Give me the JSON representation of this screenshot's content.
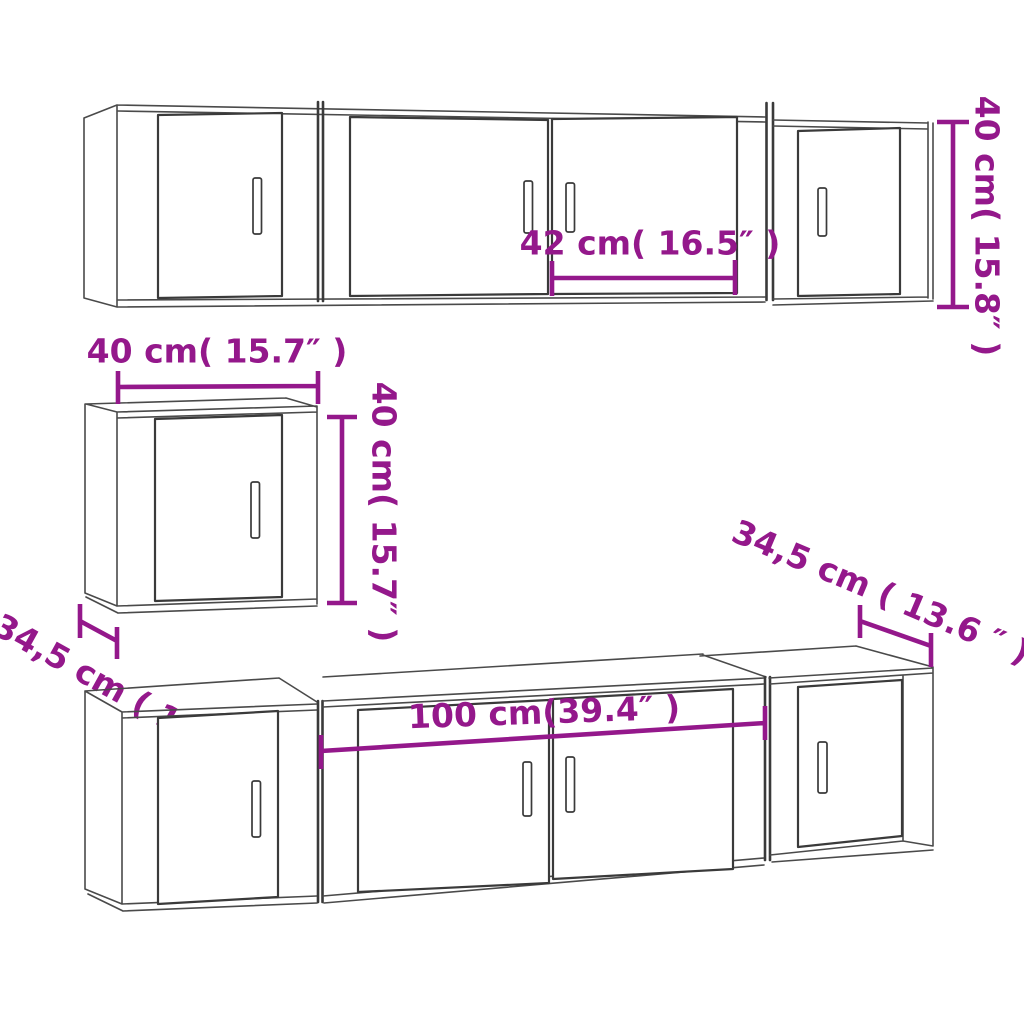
{
  "colors": {
    "background": "#ffffff",
    "line": "#4a4a4a",
    "line_dark": "#3a3a3a",
    "dimension": "#94188B"
  },
  "dims": {
    "top_door_width": "42 cm( 16.5″ )",
    "top_cabinet_height": "40 cm( 15.8″ )",
    "wall_cabinet_width": "40 cm( 15.7″ )",
    "wall_cabinet_height": "40 cm( 15.7″ )",
    "wall_cabinet_depth": "34,5 cm ( 13.6 ″ )",
    "bottom_cabinet_width": "100 cm(39.4″ )",
    "bottom_cabinet_depth": "34,5 cm ( 13.6 ″ )"
  }
}
